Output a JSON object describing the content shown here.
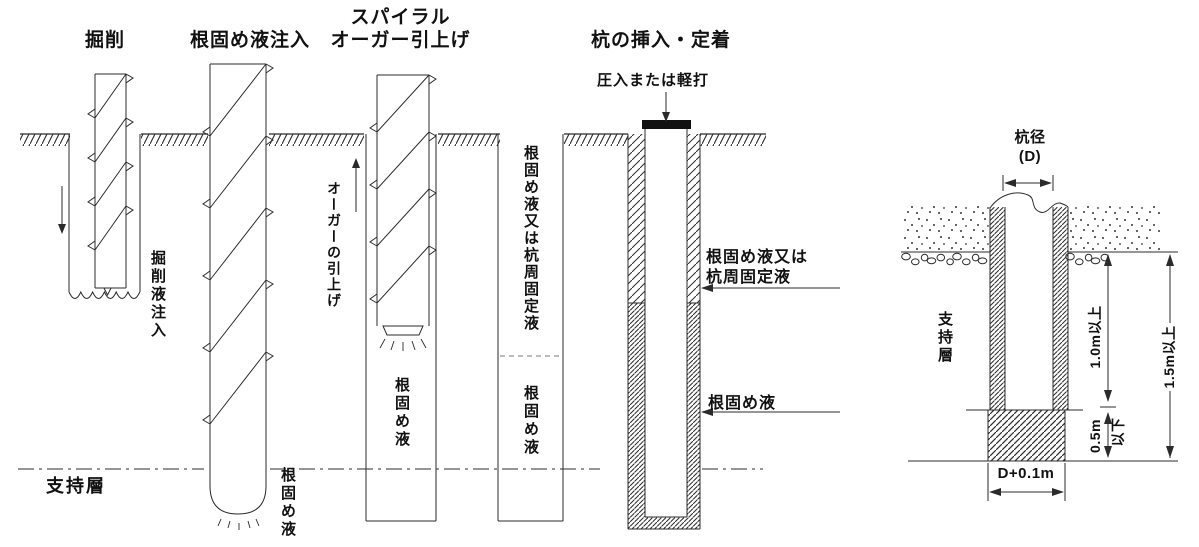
{
  "figure": {
    "labels": {
      "excavation": "掘削",
      "root_liquid_injection": "根固め液注入",
      "spiral_line1": "スパイラル",
      "spiral_line2": "オーガー引上げ",
      "pile_insertion": "杭の挿入・定着",
      "press_or_tap": "圧入または軽打",
      "drilling_fluid_injection": "掘削液注入",
      "auger_pull_up": "オーガーの引上げ",
      "root_liquid": "根固め液",
      "root_or_fixing_liquid_vertical": "根固め液又は杭周固定液",
      "root_or_fixing_l1": "根固め液又は",
      "root_or_fixing_l2": "杭周固定液",
      "bearing_stratum": "支持層"
    },
    "detail": {
      "pile_diameter": "杭径",
      "pile_diameter_symbol": "(D)",
      "bearing_stratum": "支持層",
      "embed_depth": "1.0m以上",
      "tip_gap": "0.5m",
      "tip_gap_suffix": "以下",
      "total_depth": "1.5m以上",
      "bulb_width": "D+0.1m"
    }
  }
}
